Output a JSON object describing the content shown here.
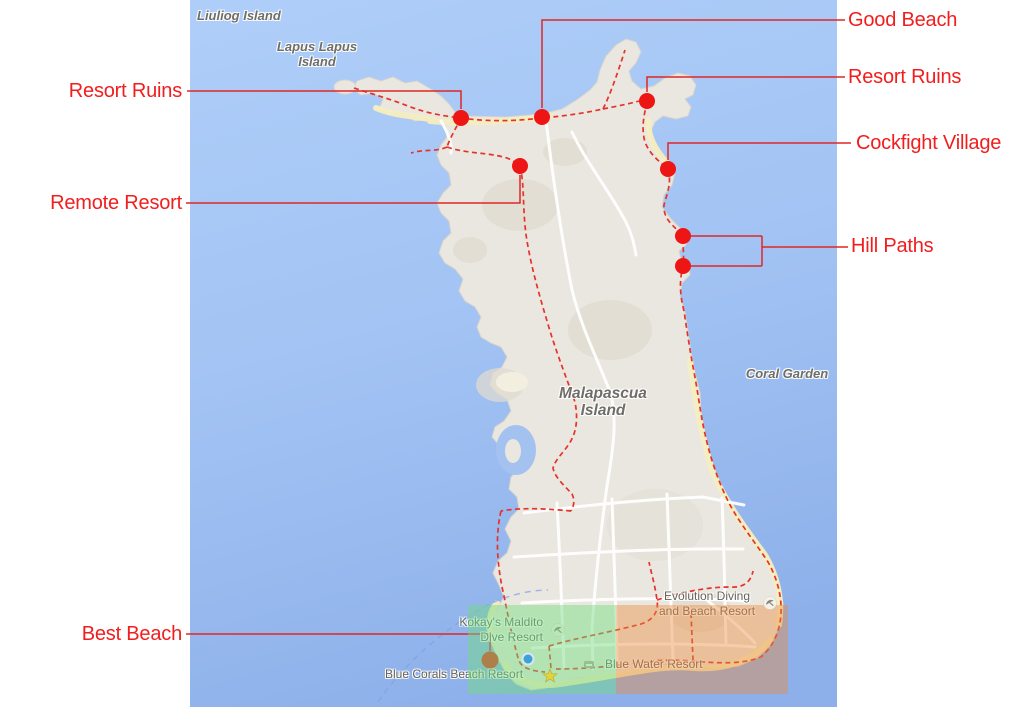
{
  "page": {
    "background": "#ffffff",
    "title": "Malapascua Island annotated map"
  },
  "map": {
    "labels": {
      "liuliog": {
        "text": "Liuliog Island"
      },
      "lapus_lapus": {
        "line1": "Lapus Lapus",
        "line2": "Island"
      },
      "malapascua": {
        "line1": "Malapascua",
        "line2": "Island"
      },
      "coral_garden": {
        "text": "Coral Garden"
      },
      "evolution": {
        "line1": "Evolution Diving",
        "line2": "and Beach Resort"
      },
      "kokays": {
        "line1": "Kokay's Maldito",
        "line2": "Dive Resort"
      },
      "blue_water": {
        "text": "Blue Water Resort"
      },
      "blue_corals": {
        "text": "Blue Corals Beach Resort"
      }
    },
    "markers": [
      {
        "name": "resort-ruins-west-dot",
        "x": 461,
        "y": 118,
        "color": "#ee1515"
      },
      {
        "name": "good-beach-dot",
        "x": 542,
        "y": 117,
        "color": "#ee1515"
      },
      {
        "name": "resort-ruins-east-dot",
        "x": 647,
        "y": 101,
        "color": "#ee1515"
      },
      {
        "name": "remote-resort-dot",
        "x": 520,
        "y": 166,
        "color": "#ee1515"
      },
      {
        "name": "cockfight-village-dot",
        "x": 668,
        "y": 169,
        "color": "#ee1515"
      },
      {
        "name": "hill-path-dot-1",
        "x": 683,
        "y": 236,
        "color": "#ee1515"
      },
      {
        "name": "hill-path-dot-2",
        "x": 683,
        "y": 266,
        "color": "#ee1515"
      },
      {
        "name": "best-beach-dot",
        "x": 490,
        "y": 660,
        "color": "#e0341f"
      }
    ],
    "colors": {
      "sea_top": "#b2d1fa",
      "sea_bottom": "#8db0ea",
      "land": "#eae7e0",
      "terrain": "#dfdbd1",
      "sand": "#f6eec0",
      "road": "#ffffff",
      "trail_red": "#e63228",
      "leader_red": "#e02626",
      "overlay_green": "#70db7c",
      "overlay_orange": "#e98a3a",
      "ferry_route_blue": "#7fa3e2",
      "map_label_gray": "#6e6c66"
    }
  },
  "annotations": {
    "text_color": "#f21d1d",
    "left": [
      {
        "id": "resort-ruins-west",
        "label": "Resort Ruins"
      },
      {
        "id": "remote-resort",
        "label": "Remote Resort"
      },
      {
        "id": "best-beach",
        "label": "Best Beach"
      }
    ],
    "right": [
      {
        "id": "good-beach",
        "label": "Good Beach"
      },
      {
        "id": "resort-ruins-east",
        "label": "Resort Ruins"
      },
      {
        "id": "cockfight-village",
        "label": "Cockfight Village"
      },
      {
        "id": "hill-paths",
        "label": "Hill Paths"
      }
    ]
  }
}
